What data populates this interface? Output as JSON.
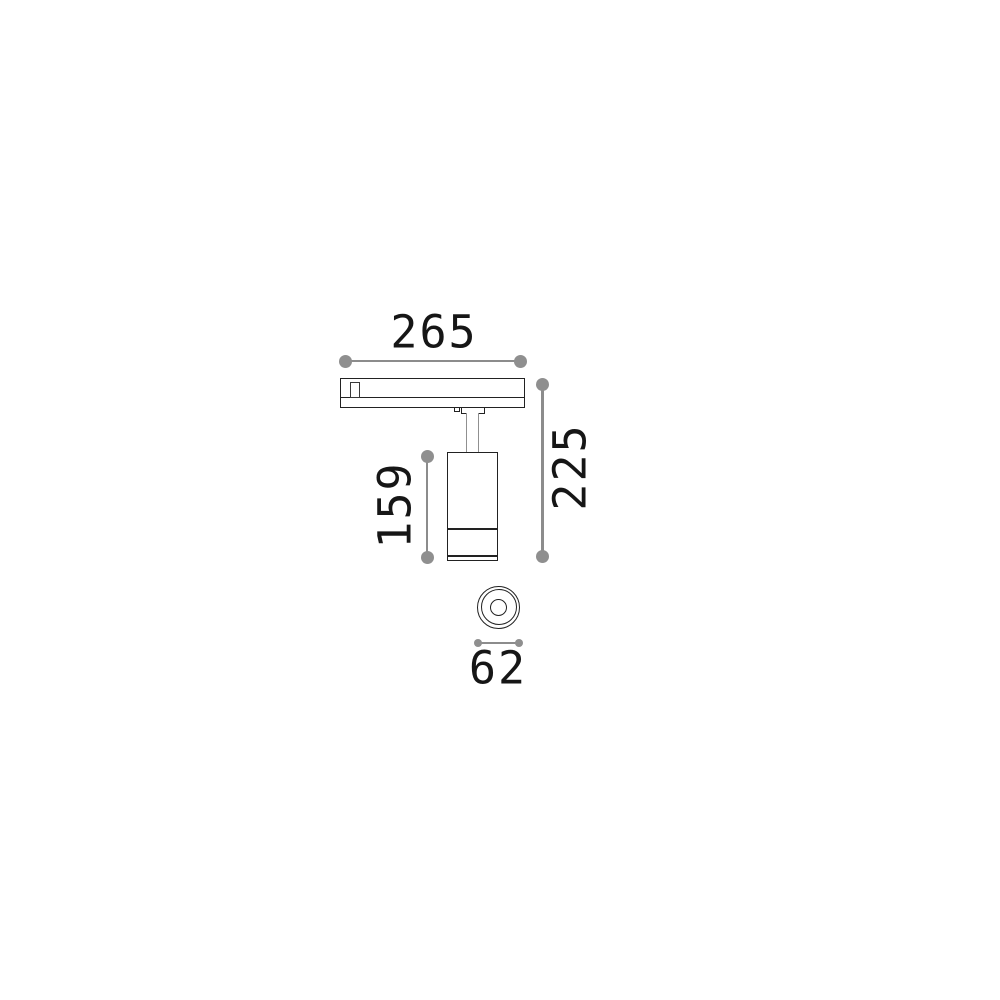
{
  "drawing": {
    "title": "track spotlight dimension drawing",
    "dimensions": {
      "top": {
        "label": "265"
      },
      "right": {
        "label": "225"
      },
      "left": {
        "label": "159"
      },
      "bottom": {
        "label": "62"
      }
    },
    "colors": {
      "dimension_gray": "#8c8c8c",
      "outline_black": "#222222",
      "stem_gray": "#909090",
      "text": "#161616",
      "background": "#ffffff"
    }
  }
}
